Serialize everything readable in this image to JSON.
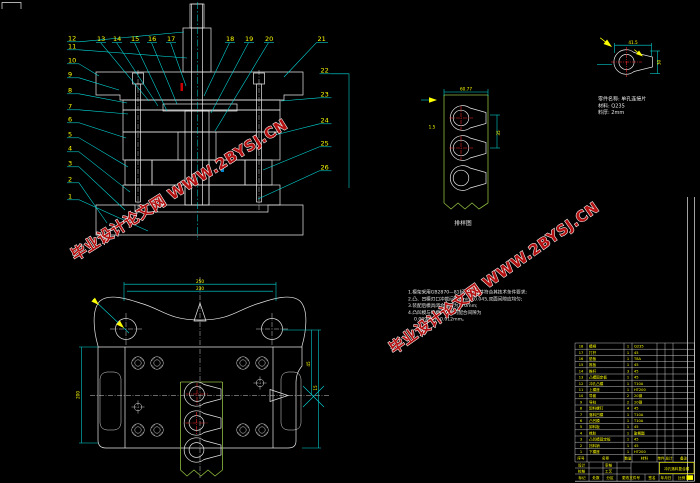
{
  "watermark": {
    "text": "毕业设计论文网 WWW.2BYSJ.CN",
    "color": "#b31111"
  },
  "section_view": {
    "balloons": [
      "1",
      "2",
      "3",
      "4",
      "5",
      "6",
      "7",
      "8",
      "9",
      "10",
      "11",
      "12",
      "13",
      "14",
      "15",
      "16",
      "17",
      "18",
      "19",
      "20",
      "21",
      "22",
      "23",
      "24",
      "25",
      "26"
    ]
  },
  "part_detail": {
    "info_lines": [
      "零件名称: 单孔连接片",
      "材料: Q235",
      "料厚: 2mm"
    ],
    "dim_width": "41.5",
    "dim_height": "30"
  },
  "strip_layout": {
    "label": "排样图",
    "dim_top": "60.77",
    "dim_side": "35",
    "dim_pitch": "1.5"
  },
  "plan_view": {
    "dim_top_outer": "250",
    "dim_top_inner": "230",
    "dim_left": "200",
    "dim_right_a": "45",
    "dim_right_b": "15"
  },
  "notes": {
    "lines": [
      "1.模架采用GB2870—81标准模架,并符合其技术条件要求;",
      "2.凸、凹模刃口冲裁间隙Zmin=0.045,双面间隙应均匀;",
      "3.装配后模具闭合高度为170mm;",
      "4.凸凹模与凹模、凸模的配合间隙为",
      "0.009mm~0.012mm。"
    ]
  },
  "bom": {
    "headers": [
      "序号",
      "名称",
      "数量",
      "材料",
      "单件",
      "总计",
      "备注"
    ],
    "rows": [
      [
        "18",
        "模柄",
        "1",
        "Q235",
        ""
      ],
      [
        "17",
        "打杆",
        "1",
        "45",
        ""
      ],
      [
        "16",
        "垫板",
        "1",
        "T8A",
        ""
      ],
      [
        "15",
        "推板",
        "1",
        "45",
        ""
      ],
      [
        "14",
        "推杆",
        "3",
        "45",
        ""
      ],
      [
        "13",
        "凸模固定板",
        "1",
        "45",
        ""
      ],
      [
        "12",
        "冲孔凸模",
        "1",
        "T10A",
        ""
      ],
      [
        "11",
        "上模座",
        "1",
        "HT200",
        ""
      ],
      [
        "10",
        "导套",
        "2",
        "20钢",
        ""
      ],
      [
        "9",
        "导柱",
        "2",
        "20钢",
        ""
      ],
      [
        "8",
        "卸料螺钉",
        "4",
        "45",
        ""
      ],
      [
        "7",
        "落料凹模",
        "1",
        "T10A",
        ""
      ],
      [
        "6",
        "凸凹模",
        "1",
        "T10A",
        ""
      ],
      [
        "5",
        "卸料板",
        "1",
        "45",
        ""
      ],
      [
        "4",
        "橡胶",
        "1",
        "聚氨酯",
        ""
      ],
      [
        "3",
        "凸凹模固定板",
        "1",
        "45",
        ""
      ],
      [
        "2",
        "挡料销",
        "1",
        "45",
        ""
      ],
      [
        "1",
        "下模座",
        "1",
        "HT200",
        ""
      ]
    ]
  },
  "title_block": {
    "drawing_title": "冲孔落料复合模",
    "left_cells": [
      "设计",
      "校核",
      "审核",
      "工艺"
    ],
    "bottom_cells": [
      "标记",
      "处数",
      "分区",
      "更改文件号",
      "签名",
      "年月日"
    ],
    "scale_label": "比例",
    "scale_value": "1:1"
  }
}
